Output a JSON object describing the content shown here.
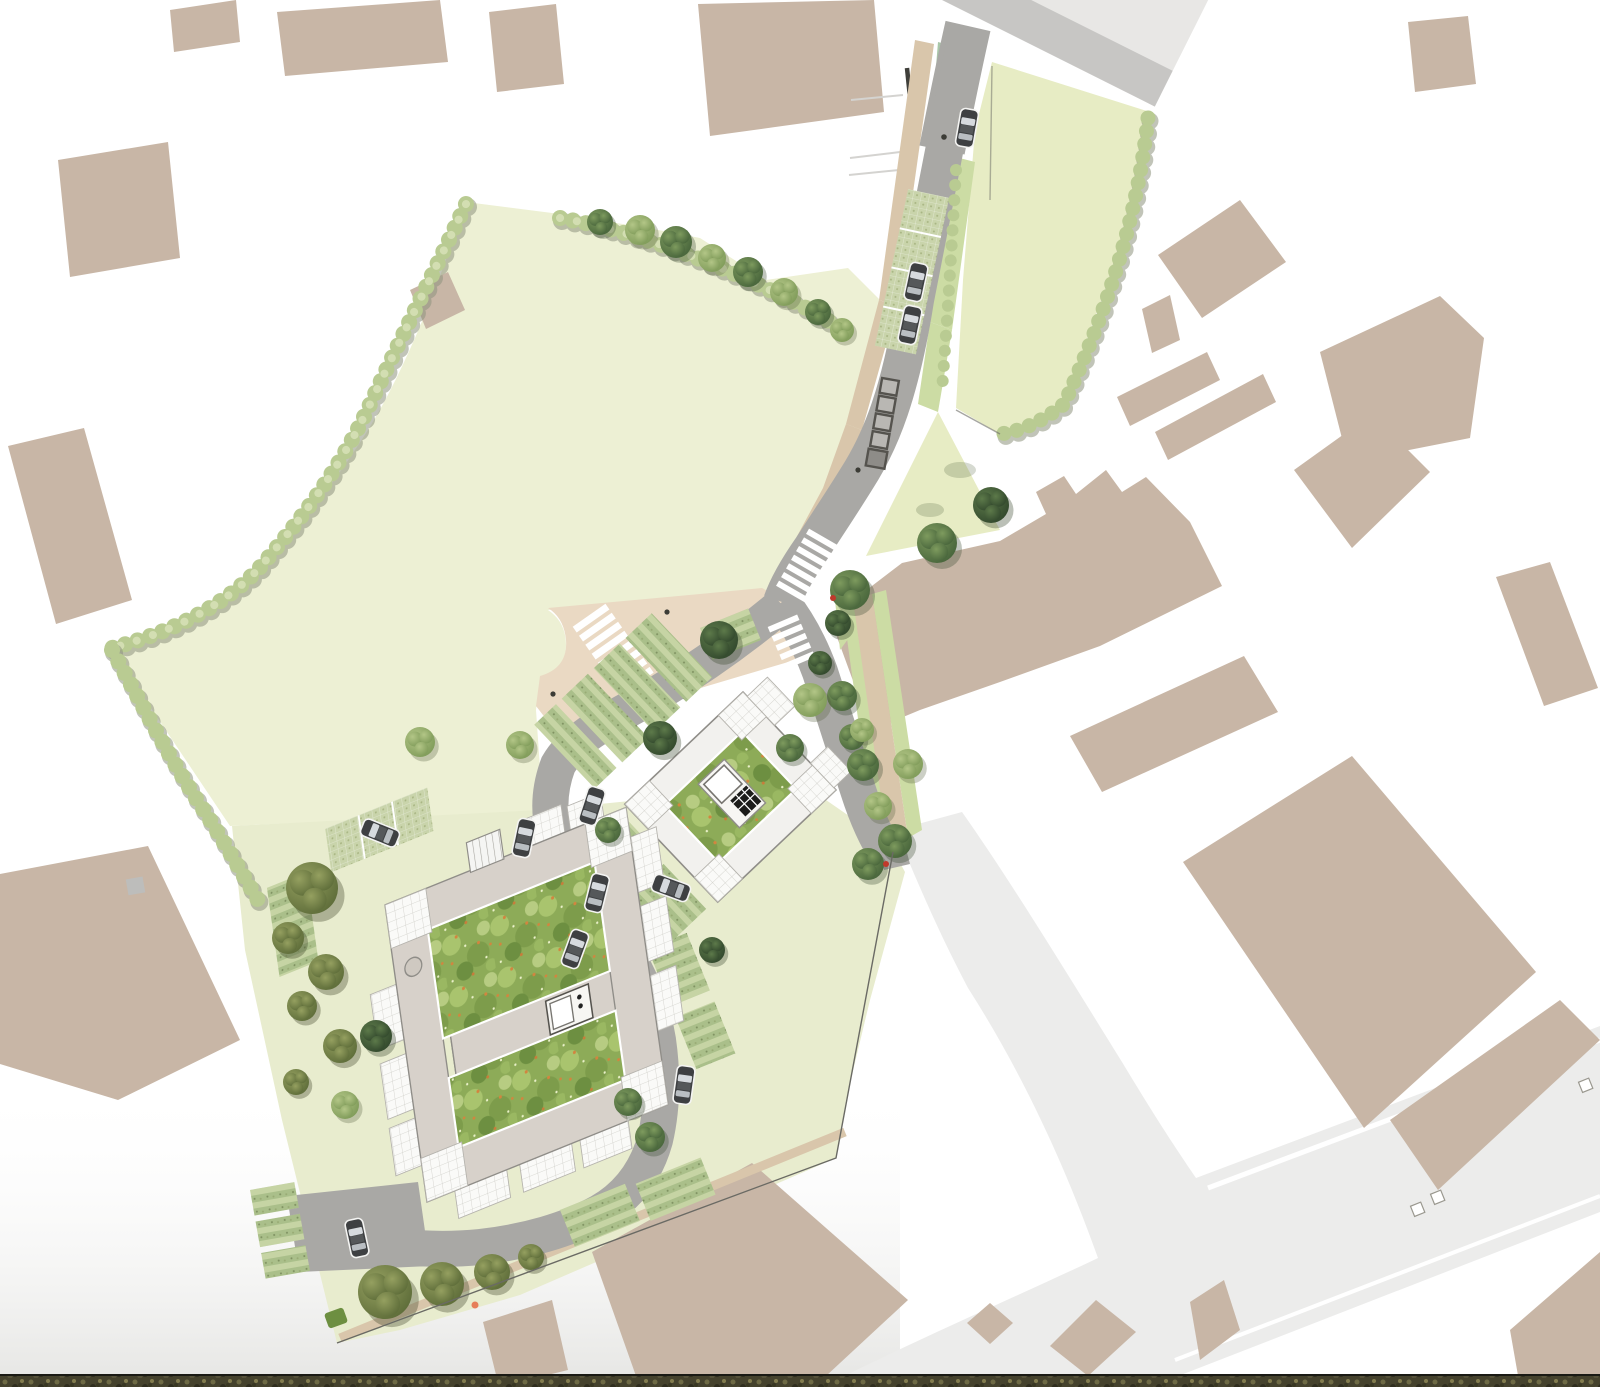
{
  "meta": {
    "title": "Landscape masterplan site plan",
    "description": "Aerial watercolour-style landscape masterplan: two courtyard buildings with green roof gardens, a looping access street with parking bays and bin store, two pale lawns edged with shrubs, street trees, zebra crossings, a light service road to the south-east, beige context building footprints and a dark boundary hedge strip along the bottom edge.",
    "page_background": "#ffffff"
  },
  "colors": {
    "page_bg": "#ffffff",
    "building_tan": "#c8b6a6",
    "road_main_edge": "#c7c6c4",
    "road_main_surface": "#e8e7e5",
    "road_site": "#a9a8a5",
    "road_service": "#ececeb",
    "lawn": "#edf0d4",
    "lawn_east": "#e7ecc4",
    "site_ground": "#e8ecce",
    "plaza_beige": "#ead9c3",
    "sidewalk_beige": "#d9c6ab",
    "verge_green": "#ccdca4",
    "raingarden": "#a9c7a8",
    "hedge_base": "#aabf8a",
    "hedge_stripe": "#c6d4a4",
    "grasscrete": "#c9d4ab",
    "garden_base": "#8dab58",
    "garden_flower": "#d2853f",
    "grid_paving": "#fafaf8",
    "grid_line": "#cfcec8",
    "roof_band": "#d7d1ca",
    "roof_edge": "#8f8d88",
    "tree_dark": "#31472c",
    "tree_mid": "#46633a",
    "tree_light": "#7e9a58",
    "tree_olive": "#5c6b38",
    "shrub": "#b9cb92",
    "shrub_hi": "#d3deb2",
    "car_body": "#3e4042",
    "car_glass": "#d6dade",
    "crossing_white": "#ffffff",
    "strip_dark": "#45422d",
    "marker_red": "#c0392b",
    "marker_orange": "#e67e5a",
    "boundary_line": "#6a6a64"
  },
  "counts": {
    "parked_cars": 11,
    "bin_store_units": 5,
    "pedestrian_crossings": 3,
    "courtyard_buildings": 2,
    "street_trees": 43,
    "context_buildings": 26
  },
  "features": [
    "context-building",
    "main-road",
    "service-road",
    "north-lawn",
    "east-lawn",
    "site-grounds",
    "pedestrian-plaza",
    "access-road",
    "zebra-crossing",
    "parking-bay",
    "bin-store",
    "courtyard-building",
    "roof-terrace",
    "courtyard-garden",
    "street-tree",
    "shrub-border",
    "parked-car",
    "boundary-hedge-strip"
  ]
}
